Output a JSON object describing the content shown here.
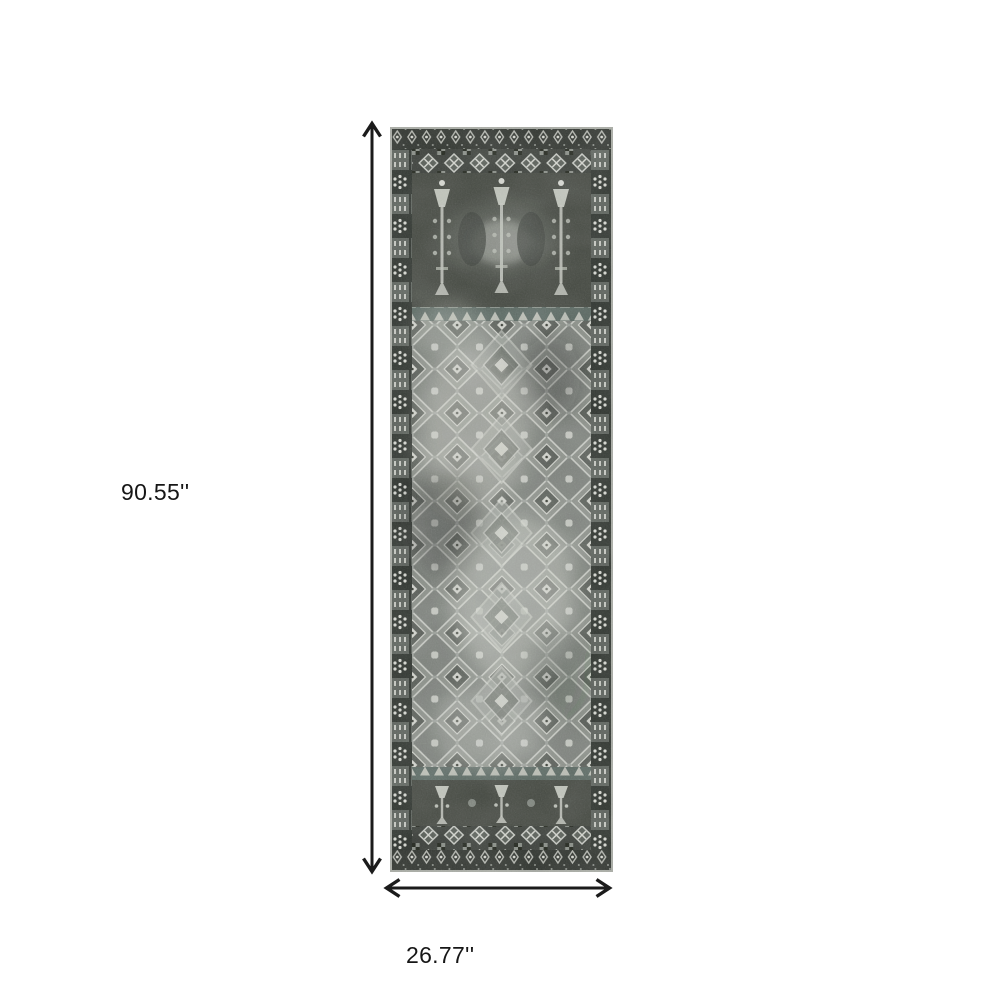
{
  "diagram": {
    "background_color": "#ffffff",
    "arrow_color": "#1b1b1b",
    "label_color": "#161616",
    "dimensions": {
      "height_label": "90.55''",
      "width_label": "26.77''"
    },
    "product": {
      "name": "runner-rug",
      "description": "Distressed vintage oriental runner rug with all-over diamond medallion pattern in charcoal, grey, ivory and teal-grey tones",
      "palette": {
        "charcoal": "#2e332e",
        "dark_grey": "#3c403c",
        "mid_grey": "#7b807a",
        "light_grey": "#b9bcb5",
        "ivory": "#d8dad2",
        "teal_grey": "#57655f"
      }
    }
  }
}
